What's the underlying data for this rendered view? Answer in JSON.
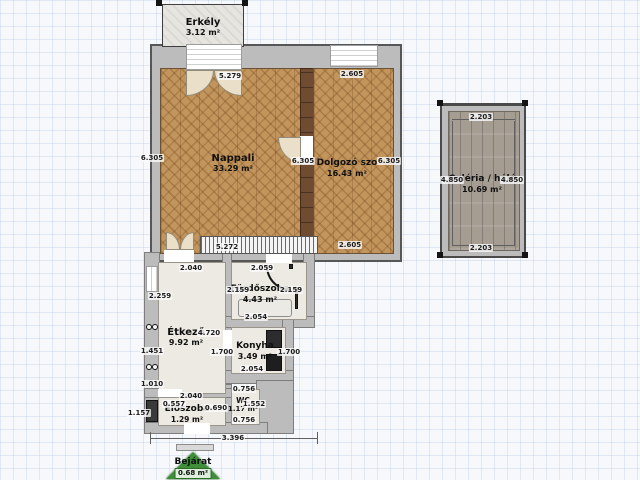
{
  "colors": {
    "background": "#f6f8fb",
    "wall": "#bcbcbc",
    "wood_floor": "#c2955c",
    "plank_floor": "#a59c92",
    "wardrobe": "#6e4b31",
    "entrance_green": "#3f8f3a"
  },
  "rooms": {
    "erkely": {
      "name": "Erkély",
      "area": "3.12 m²"
    },
    "nappali": {
      "name": "Nappali",
      "area": "33.29 m²"
    },
    "dolgozo": {
      "name": "Dolgozó szo",
      "area": "16.43 m²"
    },
    "galeria": {
      "name": "Galéria / háló",
      "area": "10.69 m²"
    },
    "etkezo": {
      "name": "Étkező",
      "area": "9.92 m²"
    },
    "furdoszoba": {
      "name": "Fürdőszoba",
      "area": "4.43 m²"
    },
    "konyha": {
      "name": "Konyha",
      "area": "3.49 m²"
    },
    "eloszoba": {
      "name": "Előszoba",
      "area": "1.29 m²"
    },
    "wc": {
      "name": "WC",
      "area": "1.17 m²"
    },
    "bejarat": {
      "name": "Bejárat",
      "area": "0.68 m²"
    }
  },
  "dimensions": [
    {
      "label": "5.279",
      "x": 230,
      "y": 76
    },
    {
      "label": "2.605",
      "x": 352,
      "y": 74
    },
    {
      "label": "6.305",
      "x": 152,
      "y": 158
    },
    {
      "label": "6.305",
      "x": 303,
      "y": 161
    },
    {
      "label": "6.305",
      "x": 389,
      "y": 161
    },
    {
      "label": "5.272",
      "x": 227,
      "y": 247
    },
    {
      "label": "2.605",
      "x": 350,
      "y": 245
    },
    {
      "label": "2.203",
      "x": 481,
      "y": 117
    },
    {
      "label": "2.203",
      "x": 481,
      "y": 248
    },
    {
      "label": "4.850",
      "x": 452,
      "y": 180
    },
    {
      "label": "4.850",
      "x": 512,
      "y": 180
    },
    {
      "label": "2.040",
      "x": 191,
      "y": 268
    },
    {
      "label": "2.059",
      "x": 262,
      "y": 268
    },
    {
      "label": "2.259",
      "x": 160,
      "y": 296
    },
    {
      "label": "2.159",
      "x": 238,
      "y": 290
    },
    {
      "label": "2.159",
      "x": 291,
      "y": 290
    },
    {
      "label": "2.054",
      "x": 256,
      "y": 317
    },
    {
      "label": "4.720",
      "x": 209,
      "y": 333
    },
    {
      "label": "1.451",
      "x": 152,
      "y": 351
    },
    {
      "label": "1.700",
      "x": 222,
      "y": 352
    },
    {
      "label": "1.700",
      "x": 289,
      "y": 352
    },
    {
      "label": "2.054",
      "x": 252,
      "y": 369
    },
    {
      "label": "1.010",
      "x": 152,
      "y": 384
    },
    {
      "label": "0.756",
      "x": 244,
      "y": 389
    },
    {
      "label": "2.040",
      "x": 191,
      "y": 396
    },
    {
      "label": "0.557",
      "x": 174,
      "y": 404
    },
    {
      "label": "0.690",
      "x": 216,
      "y": 408
    },
    {
      "label": "1.552",
      "x": 254,
      "y": 404
    },
    {
      "label": "0.756",
      "x": 244,
      "y": 420
    },
    {
      "label": "1.157",
      "x": 139,
      "y": 413
    },
    {
      "label": "3.396",
      "x": 233,
      "y": 438
    }
  ]
}
